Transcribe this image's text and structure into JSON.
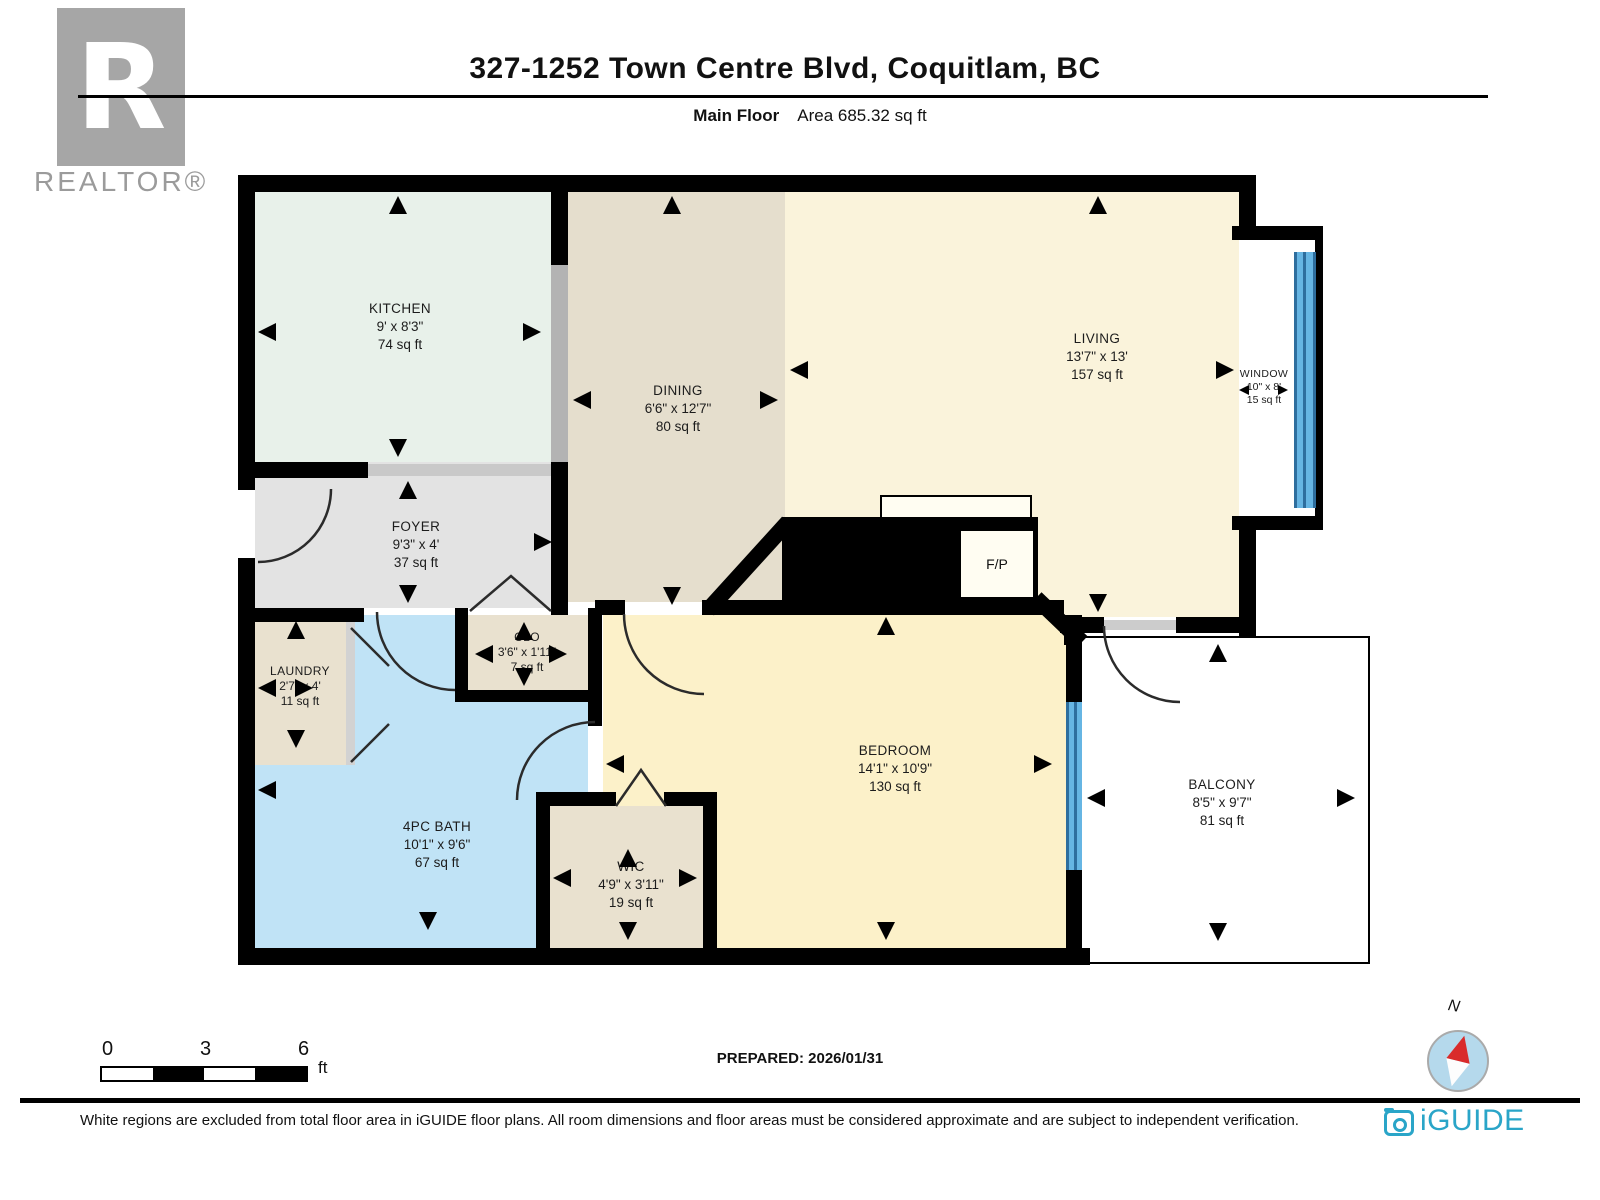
{
  "header": {
    "title": "327-1252 Town Centre Blvd, Coquitlam, BC",
    "floor_label": "Main Floor",
    "area_label": "Area 685.32 sq ft"
  },
  "branding": {
    "realtor_logo_letter": "R",
    "realtor_label": "REALTOR®",
    "iguide_label": "iGUIDE"
  },
  "rooms": {
    "kitchen": {
      "name": "KITCHEN",
      "dims": "9' x 8'3\"",
      "area": "74 sq ft"
    },
    "dining": {
      "name": "DINING",
      "dims": "6'6\" x 12'7\"",
      "area": "80 sq ft"
    },
    "living": {
      "name": "LIVING",
      "dims": "13'7\" x 13'",
      "area": "157 sq ft"
    },
    "window": {
      "name": "WINDOW",
      "dims": "10\" x 8'",
      "area": "15 sq ft"
    },
    "foyer": {
      "name": "FOYER",
      "dims": "9'3\" x 4'",
      "area": "37 sq ft"
    },
    "clo": {
      "name": "CLO",
      "dims": "3'6\" x 1'11\"",
      "area": "7 sq ft"
    },
    "laundry": {
      "name": "LAUNDRY",
      "dims": "2'7\" x 4'",
      "area": "11 sq ft"
    },
    "bath": {
      "name": "4PC BATH",
      "dims": "10'1\" x 9'6\"",
      "area": "67 sq ft"
    },
    "wic": {
      "name": "WIC",
      "dims": "4'9\" x 3'11\"",
      "area": "19 sq ft"
    },
    "bedroom": {
      "name": "BEDROOM",
      "dims": "14'1\" x 10'9\"",
      "area": "130 sq ft"
    },
    "balcony": {
      "name": "BALCONY",
      "dims": "8'5\" x 9'7\"",
      "area": "81 sq ft"
    },
    "fireplace": {
      "label": "F/P"
    }
  },
  "scale_bar": {
    "tick0": "0",
    "tick1": "3",
    "tick2": "6",
    "unit": "ft"
  },
  "prepared_label": "PREPARED: 2026/01/31",
  "compass": {
    "north_label": "N"
  },
  "footer": {
    "disclaimer": "White regions are excluded from total floor area in iGUIDE floor plans. All room dimensions and floor areas must be considered approximate and are subject to independent verification."
  },
  "colors": {
    "wall": "#000000",
    "kitchen": "#e8f1ea",
    "dining": "#e5decd",
    "living": "#faf3db",
    "bedroom": "#fcf1c9",
    "foyer": "#e3e3e3",
    "closet_beige": "#e9e1cf",
    "bath": "#c0e3f6",
    "window_glass": "#66b5e3",
    "iguide_teal": "#2aa5c8",
    "compass_red": "#d92b2b"
  }
}
